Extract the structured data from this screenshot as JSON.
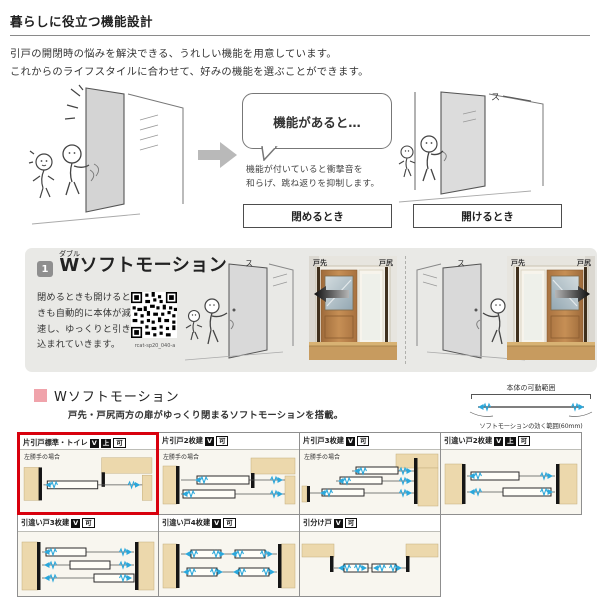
{
  "header": {
    "title": "暮らしに役立つ機能設計"
  },
  "intro": {
    "line1": "引戸の開閉時の悩みを解決できる、うれしい機能を用意しています。",
    "line2": "これからのライフスタイルに合わせて、好みの機能を選ぶことができます。"
  },
  "comic": {
    "bubble": "機能があると…",
    "caption1": "機能が付いていると衝撃音を",
    "caption2": "和らげ、跳ね返りを抑制します。",
    "label_close": "閉めるとき",
    "label_open": "開けるとき",
    "sfx": "ス"
  },
  "feature": {
    "number": "1",
    "ruby": "ダブル",
    "title_head": "W",
    "title_rest": "ソフトモーション",
    "description": "閉めるときも開けるときも自動的に本体が減速し、ゆっくりと引き込まれていきます。",
    "qr_caption": "rcat-sp20_040-a",
    "photo_label_front": "戸先",
    "photo_label_rear": "戸尻"
  },
  "soft": {
    "heading": "Wソフトモーション",
    "subtext": "戸先・戸尻両方の扉がゆっくり閉まるソフトモーションを搭載。",
    "range_title": "本体の可動範囲",
    "range_note": "ソフトモーションの効く範囲(60mm)"
  },
  "table": {
    "row1": [
      {
        "title": "片引戸標準・トイレ",
        "badges": [
          "V",
          "上",
          "可"
        ],
        "note": "左勝手の場合"
      },
      {
        "title": "片引戸2枚建",
        "badges": [
          "V",
          "可"
        ],
        "note": "左勝手の場合"
      },
      {
        "title": "片引戸3枚建",
        "badges": [
          "V",
          "可"
        ],
        "note": "左勝手の場合"
      },
      {
        "title": "引違い戸2枚建",
        "badges": [
          "V",
          "上",
          "可"
        ],
        "note": ""
      }
    ],
    "row2": [
      {
        "title": "引違い戸3枚建",
        "badges": [
          "V",
          "可"
        ],
        "note": ""
      },
      {
        "title": "引違い戸4枚建",
        "badges": [
          "V",
          "可"
        ],
        "note": ""
      },
      {
        "title": "引分け戸",
        "badges": [
          "V",
          "可"
        ],
        "note": ""
      }
    ]
  },
  "colors": {
    "accent_cyan": "#2aa7db",
    "highlight_red": "#d8000d",
    "pink": "#f0a3ab",
    "panel_gray": "#e9e9e6",
    "wood": "#b5814e",
    "tan": "#ecd8ac"
  }
}
